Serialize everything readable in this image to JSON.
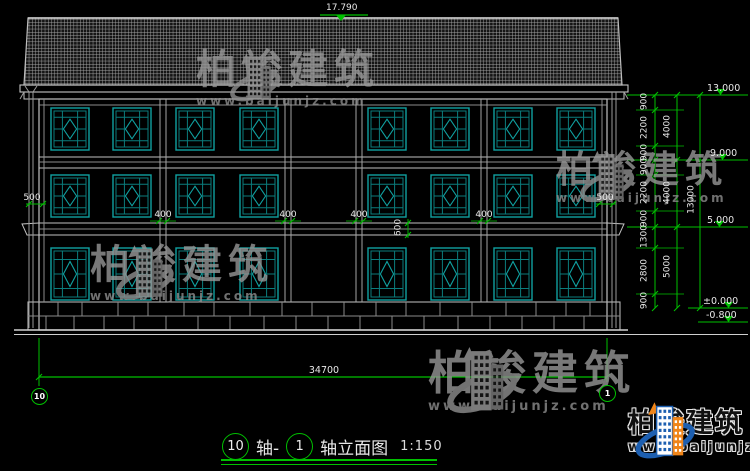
{
  "drawing": {
    "title": {
      "axis_start": "10",
      "separator": "轴-",
      "axis_end": "1",
      "suffix": "轴立面图",
      "scale": "1:150"
    },
    "axis_bubbles": {
      "left": "10",
      "right": "1"
    },
    "dimensions": {
      "ridge_elevation": "17.790",
      "overall_width": "34700",
      "overall_height": "13000",
      "levels": [
        "13.000",
        "9.000",
        "5.000",
        "±0.000",
        "-0.800"
      ],
      "floor_segments": [
        "900",
        "2200",
        "900",
        "900",
        "2200",
        "900",
        "1300",
        "2800",
        "900"
      ],
      "floor_totals": [
        "4000",
        "4000",
        "5000"
      ],
      "column_widths": [
        "400",
        "400",
        "400",
        "400"
      ],
      "eave_overhangs": [
        "500",
        "500"
      ],
      "beam_depth": "600"
    }
  },
  "watermark": {
    "brand": "柏竣建筑",
    "url": "www.baijunjz.com"
  },
  "logo": {
    "brand": "柏竣建筑",
    "url": "www.baijunjz.com"
  },
  "colors": {
    "dim_green": "#00c000",
    "window_teal": "#10a0a0",
    "window_teal_dim": "#0b7d7d",
    "line_white": "#c8c8c8",
    "line_gray": "#989898",
    "logo_blue": "#1d5fb0",
    "logo_orange": "#f08519",
    "watermark_gray": "#979797"
  }
}
